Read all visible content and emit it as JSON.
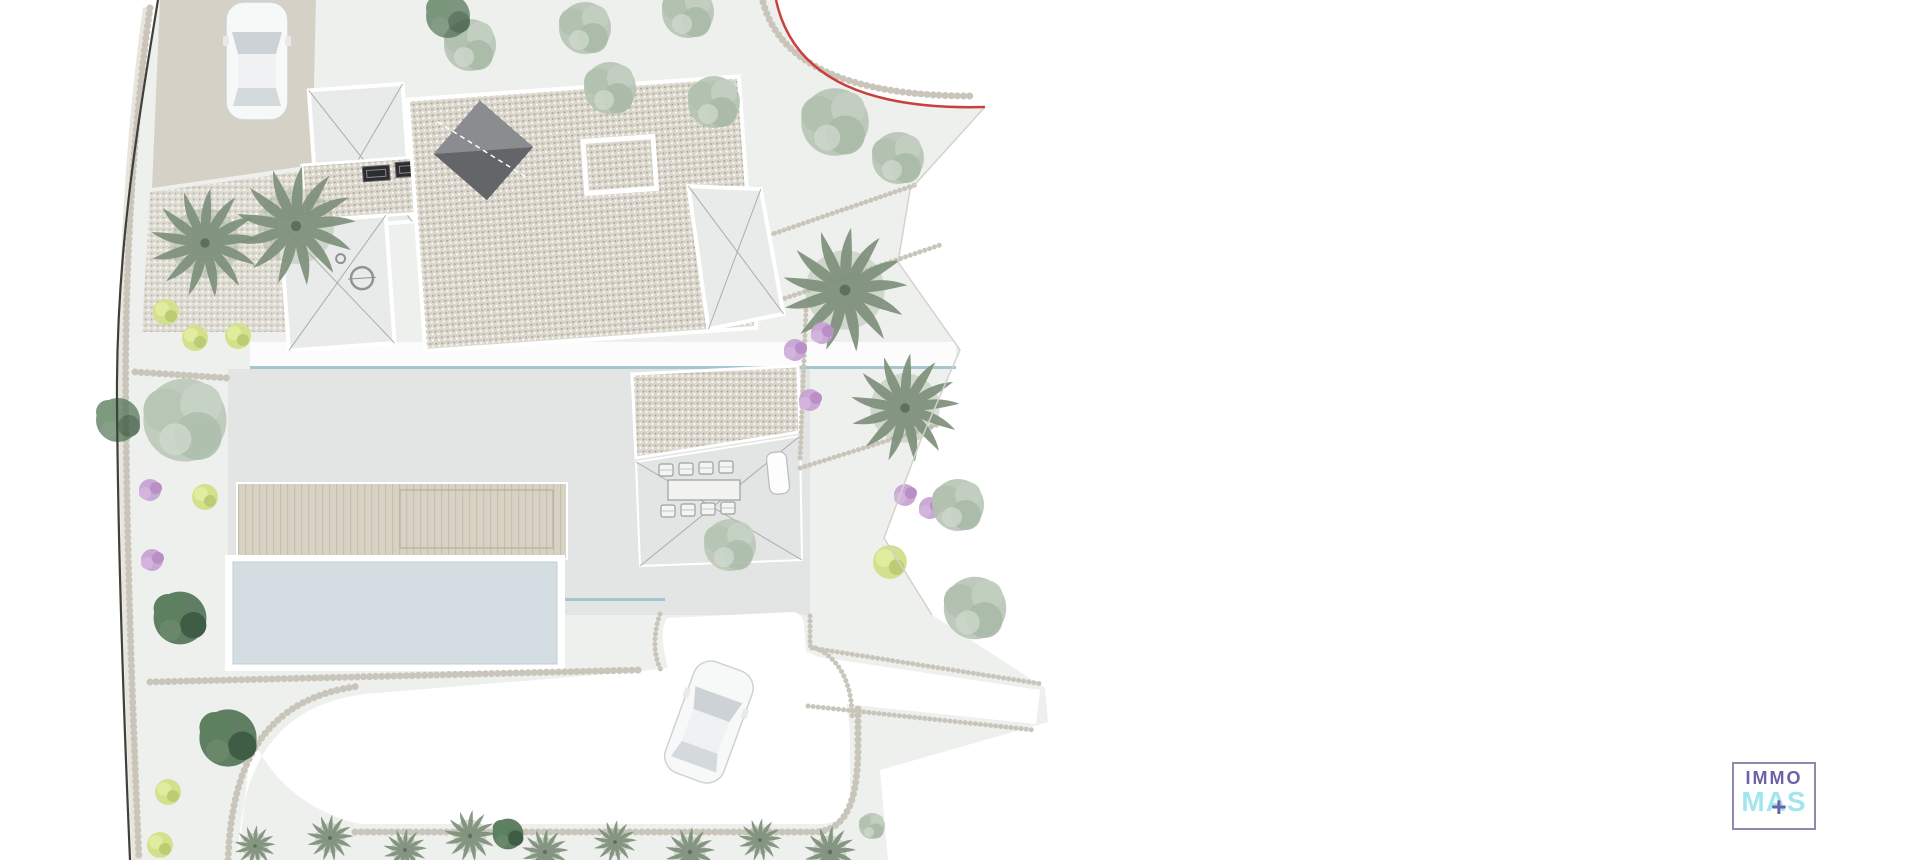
{
  "logo": {
    "line1": "IMMO",
    "line2": "MAS",
    "plus": "+"
  },
  "colors": {
    "plan_bg": "#eef0ed",
    "boundary": "#3f4039",
    "stipple": "#c9c5ba",
    "band": "#e8e5dc",
    "gravel_bg": "#dcd8ce",
    "gravel_dot": "#a9a399",
    "drive_beige": "#d5d1c6",
    "terrace": "#e3e5e4",
    "deck": "#d8d2c4",
    "deck_stripe": "#c6c0b0",
    "pool": "#d3dde2",
    "water_line": "#a5c6ce",
    "road_red": "#c9403c",
    "roof_dark1": "#8b8c90",
    "roof_dark2": "#646568",
    "panel_dark": "#2c2d30",
    "xpanel": "#e9ebea",
    "xline": "#a8aeac",
    "tree_sage": "#b3c2b0",
    "tree_dark": "#4f7153",
    "bush_yellow": "#d3e18c",
    "bush_purple": "#c5a0d2",
    "palm": "#7e907b",
    "car_body": "#f7f8f8",
    "car_glass": "#ccd2d6",
    "car_stroke": "#cfd2d4",
    "logo_purple": "#6b63a8",
    "logo_cyan": "#9fe6ef",
    "logo_border": "#8e8aad"
  }
}
